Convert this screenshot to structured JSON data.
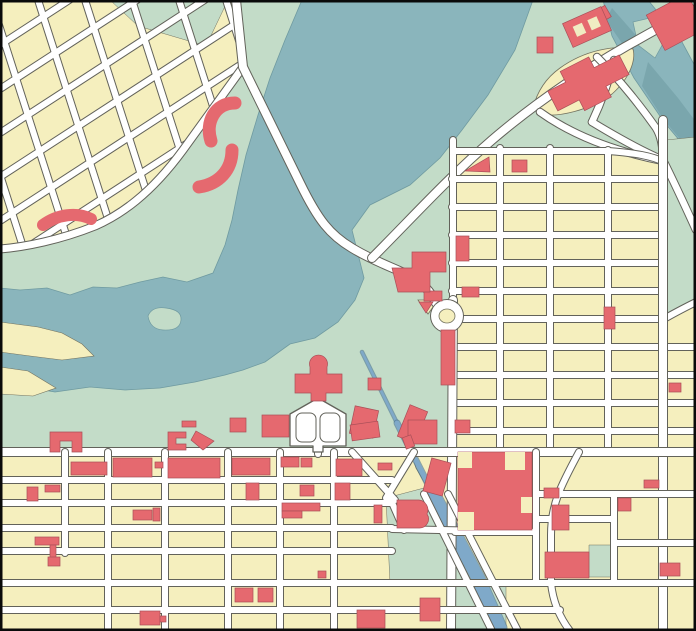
{
  "map": {
    "width": 696,
    "height": 631,
    "kind": "city-vector-map",
    "visible_text": []
  },
  "palette": {
    "park": "#c3dcc8",
    "water": "#8ab5bc",
    "water_dark": "#7aa6ad",
    "water_edge": "#6f9aa0",
    "block": "#f5efbe",
    "block_edge": "#72725f",
    "building": "#e5696f",
    "building_edge": "#a94f58",
    "road_fill": "#ffffff",
    "road_casing": "#62625a",
    "canal": "#7fa9c9",
    "canal_edge": "#48728f",
    "frame": "#0a0a0a"
  },
  "features": {
    "waters": [
      {
        "name": "lake",
        "d": "M302,0 L285,40 L270,78 L258,115 L246,155 L238,190 L232,220 L225,245 L213,273 L187,282 L163,277 L140,282 L117,288 L93,287 L70,295 L47,288 L20,290 L0,288 L0,390 L25,387 L55,392 L90,387 L125,390 L160,388 L195,382 L225,375 L243,370 L265,362 L290,344 L315,338 L338,322 L355,300 L364,278 L360,262 L352,230 L370,205 L410,185 L440,158 L462,130 L488,95 L515,50 L533,0 Z"
      },
      {
        "name": "river",
        "d": "M603,0 L648,0 L682,42 L696,68 L696,160 L664,122 L634,78 L612,36 Z"
      }
    ],
    "water_darks": [
      {
        "name": "river-channel",
        "d": "M648,62 L678,98 L696,122 L696,158 L664,120 L642,86 Z"
      },
      {
        "name": "river-channel-2",
        "d": "M612,8 L640,40 L628,52 L606,20 Z"
      }
    ],
    "sands": [
      {
        "name": "spit-1",
        "d": "M0,322 L38,327 L62,333 L82,344 L94,356 L62,360 L30,356 L0,352 Z"
      },
      {
        "name": "spit-2",
        "d": "M0,367 L28,371 L56,388 L33,396 L0,394 Z"
      }
    ],
    "islands": [
      {
        "name": "lake-island",
        "d": "M148,316 Q152,306 166,308 Q182,310 181,320 Q180,331 163,330 Q150,329 148,316 Z"
      },
      {
        "name": "river-island",
        "d": "M633,22 L650,18 L666,38 L655,58 L638,45 Z"
      }
    ],
    "yellow_areas": [
      {
        "name": "blocks-topleft",
        "d": "M0,0 L236,0 L243,67 L183,150 L120,215 L60,237 L0,250 Z"
      },
      {
        "name": "blocks-right-grid",
        "d": "M455,148 L616,148 L664,162 L696,162 L696,452 L455,452 Z"
      },
      {
        "name": "blocks-bottom-grid",
        "d": "M0,452 L696,452 L696,631 L0,631 Z"
      },
      {
        "name": "block-lens",
        "d": "M533,108 C537,92 546,78 560,68 C585,50 615,45 633,49 C636,60 630,78 612,94 C590,110 558,118 540,114 Z"
      },
      {
        "name": "wedge-roundabout",
        "d": "M418,300 L438,300 L428,314 Z"
      },
      {
        "name": "wedge-canal",
        "d": "M412,455 L453,455 L453,520 L437,504 L416,468 Z"
      }
    ],
    "green_overlays": [
      {
        "name": "notch-top",
        "d": "M110,0 L228,0 L206,46 L138,26 Z"
      },
      {
        "name": "strip-right-edge",
        "d": "M666,140 L696,137 L696,300 Q678,308 666,322 Z"
      },
      {
        "name": "canal-bank-upper",
        "d": "M386,498 L424,488 L446,516 L462,534 L464,560 L464,583 L390,583 Z"
      },
      {
        "name": "canal-bank-lower",
        "d": "M452,586 L506,586 L506,631 L452,631 Z"
      },
      {
        "name": "park-square",
        "d": "M589,545 L611,545 L611,577 L589,577 Z"
      }
    ],
    "canal_segments": [
      {
        "name": "canal-head",
        "d": "M362,352 L397,423",
        "w": 2.5
      },
      {
        "name": "canal-mid",
        "d": "M397,423 L432,492",
        "w": 5
      },
      {
        "name": "canal-main",
        "d": "M432,492 L458,540 L478,578 L500,628",
        "w": 13
      }
    ],
    "street_groups": [
      {
        "name": "streets-topleft-grid",
        "clip": "clip-tlgrid",
        "w": 6,
        "paths": [
          "M-150,0 L-54,300",
          "M-103,0 L-7,300",
          "M-56,0 L40,300",
          "M-9,0 L87,300",
          "M38,0 L134,300",
          "M85,0 L181,300",
          "M132,0 L228,300",
          "M179,0 L275,300",
          "M226,0 L322,300",
          "M0,45 L400,-215",
          "M0,89 L400,-171",
          "M0,133 L400,-127",
          "M0,177 L400,-83",
          "M0,221 L400,-39",
          "M0,265 L400,5",
          "M0,309 L400,49"
        ]
      },
      {
        "name": "street-shore-road",
        "w": 7,
        "paths": [
          "M243,67 L183,150 C150,195 120,215 95,226 C60,240 25,247 0,249"
        ]
      },
      {
        "name": "street-causeway",
        "w": 8,
        "paths": [
          "M236,0 L243,67 L300,183 C318,220 330,235 352,248 C375,262 395,268 410,276 C425,284 432,294 436,303"
        ]
      },
      {
        "name": "street-highway",
        "w": 8,
        "paths": [
          "M372,258 C410,220 448,178 492,140 C540,99 585,70 625,47 C650,33 672,20 696,9"
        ]
      },
      {
        "name": "streets-interchange",
        "w": 6.5,
        "paths": [
          "M597,57 C620,80 642,108 656,128 C661,136 663,148 663,160",
          "M540,112 C575,137 618,152 663,161",
          "M663,160 C676,186 686,208 696,230",
          "M614,60 C608,85 600,105 592,122",
          "M592,122 C615,136 640,150 663,160"
        ]
      },
      {
        "name": "streets-right-grid",
        "w": 6,
        "paths": [
          "M453,140 L453,300",
          "M500,148 L500,452",
          "M550,148 L550,452",
          "M608,150 L608,452",
          "M455,151 L608,151 C635,153 652,156 664,162",
          "M452,179 L664,179",
          "M452,207 L664,207",
          "M452,235 L664,235",
          "M452,263 L664,263",
          "M452,291 L664,291",
          "M452,319 L664,319",
          "M452,347 L696,347",
          "M452,375 L696,375",
          "M452,403 L696,403",
          "M452,431 L696,431",
          "M664,319 C676,312 686,307 696,302"
        ]
      },
      {
        "name": "street-main-vertical",
        "w": 8,
        "paths": [
          "M453,300 L451,631",
          "M663,120 L663,631"
        ]
      },
      {
        "name": "street-grid-top-major",
        "w": 8,
        "paths": [
          "M0,452 L696,452"
        ]
      },
      {
        "name": "streets-bottom-grid",
        "w": 6,
        "paths": [
          "M0,480 L392,480",
          "M0,503 L392,503",
          "M0,528 L392,528",
          "M392,529 L536,532",
          "M0,551 L392,551",
          "M0,583 L696,583",
          "M0,610 L560,610",
          "M65,452 L65,553",
          "M108,452 L108,631",
          "M165,452 L165,631",
          "M228,452 L228,631",
          "M280,452 L280,631",
          "M334,452 L334,631",
          "M536,452 L536,583",
          "M614,494 L614,583",
          "M455,532 L536,532",
          "M536,494 L696,494",
          "M536,519 L614,519",
          "M614,543 L696,543",
          "M352,452 L395,500",
          "M414,452 L386,498",
          "M390,498 L404,530",
          "M424,494 L492,631",
          "M448,494 L518,631",
          "M579,452 C560,487 551,505 551,535 L551,583",
          "M551,583 C553,602 560,618 570,631",
          "M318,444 L318,454"
        ]
      }
    ],
    "roundabout": {
      "name": "roundabout",
      "cx": 447,
      "cy": 316,
      "r_out": 16,
      "r_in": 8
    },
    "garden": {
      "name": "formal-garden",
      "outer": "M318,398 L346,414 L346,446 L323,446 L323,452 L313,452 L313,446 L290,446 L290,414 Z",
      "loops": [
        [
          296,
          413,
          20,
          29
        ],
        [
          320,
          413,
          20,
          29
        ]
      ]
    },
    "building_rects": [
      [
        595,
        8,
        14,
        13,
        -30
      ],
      [
        537,
        37,
        16,
        16,
        0
      ],
      [
        512,
        160,
        15,
        12,
        0
      ],
      [
        456,
        236,
        13,
        25,
        0
      ],
      [
        462,
        287,
        17,
        10,
        0
      ],
      [
        604,
        307,
        11,
        22,
        0
      ],
      [
        669,
        383,
        12,
        9,
        0
      ],
      [
        441,
        330,
        14,
        55,
        0
      ],
      [
        368,
        378,
        13,
        12,
        0
      ],
      [
        230,
        418,
        16,
        14,
        0
      ],
      [
        262,
        415,
        27,
        22,
        0
      ],
      [
        352,
        408,
        24,
        28,
        12
      ],
      [
        403,
        407,
        19,
        34,
        22
      ],
      [
        182,
        421,
        14,
        6,
        0
      ],
      [
        351,
        423,
        28,
        16,
        -8
      ],
      [
        455,
        420,
        15,
        13,
        0
      ],
      [
        408,
        420,
        29,
        24,
        0
      ],
      [
        404,
        436,
        9,
        12,
        -20
      ],
      [
        427,
        460,
        20,
        34,
        15
      ],
      [
        71,
        462,
        36,
        13,
        0
      ],
      [
        113,
        458,
        39,
        19,
        0
      ],
      [
        155,
        462,
        8,
        6,
        0
      ],
      [
        168,
        458,
        52,
        20,
        0
      ],
      [
        232,
        458,
        38,
        17,
        0
      ],
      [
        281,
        457,
        18,
        10,
        0
      ],
      [
        301,
        458,
        11,
        9,
        0
      ],
      [
        336,
        459,
        26,
        17,
        0
      ],
      [
        378,
        463,
        14,
        7,
        0
      ],
      [
        27,
        487,
        11,
        14,
        0
      ],
      [
        45,
        485,
        15,
        7,
        0
      ],
      [
        246,
        483,
        13,
        17,
        0
      ],
      [
        300,
        485,
        14,
        11,
        0
      ],
      [
        335,
        483,
        15,
        17,
        0
      ],
      [
        133,
        510,
        19,
        10,
        0
      ],
      [
        153,
        508,
        7,
        13,
        0
      ],
      [
        282,
        503,
        38,
        8,
        0
      ],
      [
        282,
        511,
        20,
        7,
        0
      ],
      [
        374,
        505,
        8,
        18,
        0
      ],
      [
        35,
        537,
        24,
        8,
        0
      ],
      [
        50,
        545,
        6,
        13,
        0
      ],
      [
        48,
        557,
        12,
        9,
        0
      ],
      [
        318,
        571,
        8,
        7,
        0
      ],
      [
        235,
        588,
        18,
        14,
        0
      ],
      [
        258,
        588,
        15,
        14,
        0
      ],
      [
        140,
        611,
        20,
        14,
        0
      ],
      [
        160,
        616,
        6,
        6,
        0
      ],
      [
        357,
        610,
        28,
        18,
        0
      ],
      [
        420,
        598,
        20,
        23,
        0
      ],
      [
        544,
        488,
        15,
        10,
        0
      ],
      [
        552,
        505,
        17,
        25,
        0
      ],
      [
        545,
        552,
        44,
        26,
        0
      ],
      [
        660,
        563,
        20,
        13,
        0
      ],
      [
        618,
        498,
        13,
        13,
        0
      ],
      [
        644,
        480,
        15,
        8,
        0
      ],
      [
        653,
        2,
        46,
        40,
        -28
      ],
      [
        424,
        291,
        18,
        10,
        0
      ],
      [
        458,
        452,
        74,
        78,
        0
      ]
    ],
    "building_paths": [
      {
        "name": "building-mall",
        "d": "M-40,-10 L-20,-10 L-20,-22 L12,-22 L12,-10 L40,-10 L40,12 L14,12 L14,24 L-16,24 L-16,12 L-40,12 Z",
        "tf": "translate(588,82) rotate(-27)"
      },
      {
        "name": "building-stepped",
        "d": "M392,268 L412,268 L412,252 L446,252 L446,272 L430,272 L430,292 L398,292 Z"
      },
      {
        "name": "building-triangle",
        "d": "M465,171 L489,157 L490,172 Z"
      },
      {
        "name": "building-pi",
        "d": "M50,432 L82,432 L82,452 L72,452 L72,441 L60,441 L60,452 L50,452 Z"
      },
      {
        "name": "building-c",
        "d": "M168,432 L186,432 L186,438 L176,438 L176,444 L186,444 L186,450 L168,450 Z"
      },
      {
        "name": "building-arrow",
        "d": "M196,431 L214,441 L203,450 L191,440 Z"
      },
      {
        "name": "building-cathedral",
        "d": "M295,374 L310,374 L310,367 A9,9 0 1 1 327,367 L327,374 L342,374 L342,393 L326,393 L326,401 L311,401 L311,393 L295,393 Z"
      },
      {
        "name": "building-round",
        "d": "M397,500 h22 a10,10 0 0 1 8,14 a9,9 0 0 1 -8,14 h-22 Z"
      },
      {
        "name": "building-wedge",
        "d": "M419,302 L433,302 L426,313 Z"
      }
    ],
    "building_arcs": [
      {
        "name": "building-crescent-1",
        "d": "M235,103 C215,103 205,122 211,141",
        "w": 13
      },
      {
        "name": "building-crescent-2",
        "d": "M232,150 C232,170 219,184 199,187",
        "w": 13
      },
      {
        "name": "building-banana",
        "d": "M43,225 C58,214 77,212 91,219",
        "w": 12
      }
    ],
    "figure8": {
      "name": "building-figure8",
      "cx": 587,
      "cy": 27,
      "rot": -24,
      "w": 42,
      "h": 26,
      "holes": [
        [
          -13,
          -6,
          10,
          11
        ],
        [
          3,
          -6,
          10,
          11
        ]
      ]
    },
    "complex_notches": [
      [
        458,
        452,
        14,
        16
      ],
      [
        505,
        452,
        20,
        18
      ],
      [
        458,
        512,
        16,
        18
      ],
      [
        521,
        497,
        11,
        16
      ]
    ],
    "clip_tlgrid": "M0,0 L236,0 L243,67 L183,150 L120,215 L60,237 L0,250 Z"
  }
}
